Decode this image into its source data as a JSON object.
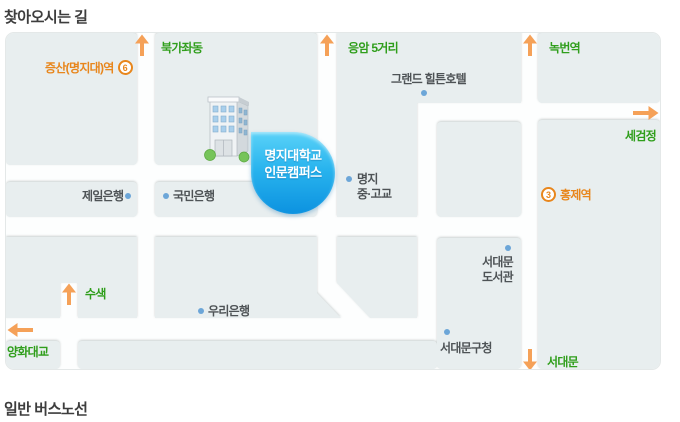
{
  "page": {
    "title": "찾아오시는 길",
    "section_below": "일반 버스노선"
  },
  "colors": {
    "green_label": "#2f9e1b",
    "orange_label": "#e8861c",
    "arrow_orange": "#f5a158",
    "poi_dot_blue": "#6ca6d8",
    "bubble_blue_top": "#5ad2f8",
    "bubble_blue_bottom": "#0c92e0",
    "block_gray": "#e8eeef"
  },
  "map": {
    "bubble": {
      "line1": "명지대학교",
      "line2": "인문캠퍼스"
    },
    "subway": {
      "jeungsan": {
        "line_number": "6",
        "name": "증산(명지대)역"
      },
      "hongje": {
        "line_number": "3",
        "name": "홍제역"
      }
    },
    "directions": {
      "bukgajwadong": "북가좌동",
      "eungam": "응암 5거리",
      "nokbeon": "녹번역",
      "segeomjeong": "세검정",
      "susaek": "수색",
      "yanghwadaegyo": "양화대교",
      "seodaemun": "서대문"
    },
    "places": {
      "hilton": "그랜드 힐튼호텔",
      "jeil_bank": "제일은행",
      "kookmin_bank": "국민은행",
      "myongji_school_line1": "명지",
      "myongji_school_line2": "중·고교",
      "library_line1": "서대문",
      "library_line2": "도서관",
      "woori_bank": "우리은행",
      "gu_office": "서대문구청"
    }
  }
}
